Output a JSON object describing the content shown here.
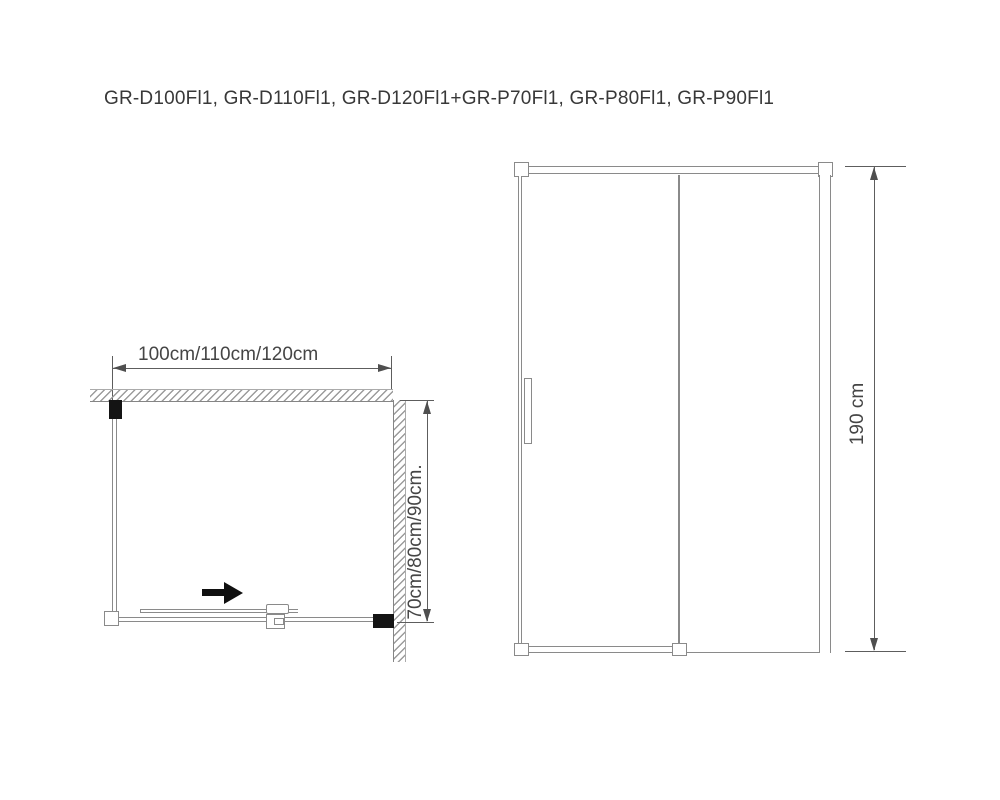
{
  "title": "GR-D100Fl1, GR-D110Fl1, GR-D120Fl1+GR-P70Fl1, GR-P80Fl1, GR-P90Fl1",
  "plan_view": {
    "width_label": "100cm/110cm/120cm",
    "depth_label": "70cm/80cm/90cm.",
    "slide_direction": "right"
  },
  "front_view": {
    "height_label": "190 cm"
  },
  "colors": {
    "background": "#ffffff",
    "drawing_line": "#8a8a8a",
    "dimension_line": "#5d5d5d",
    "solid_fill": "#141414",
    "text": "#3a3a3a"
  }
}
